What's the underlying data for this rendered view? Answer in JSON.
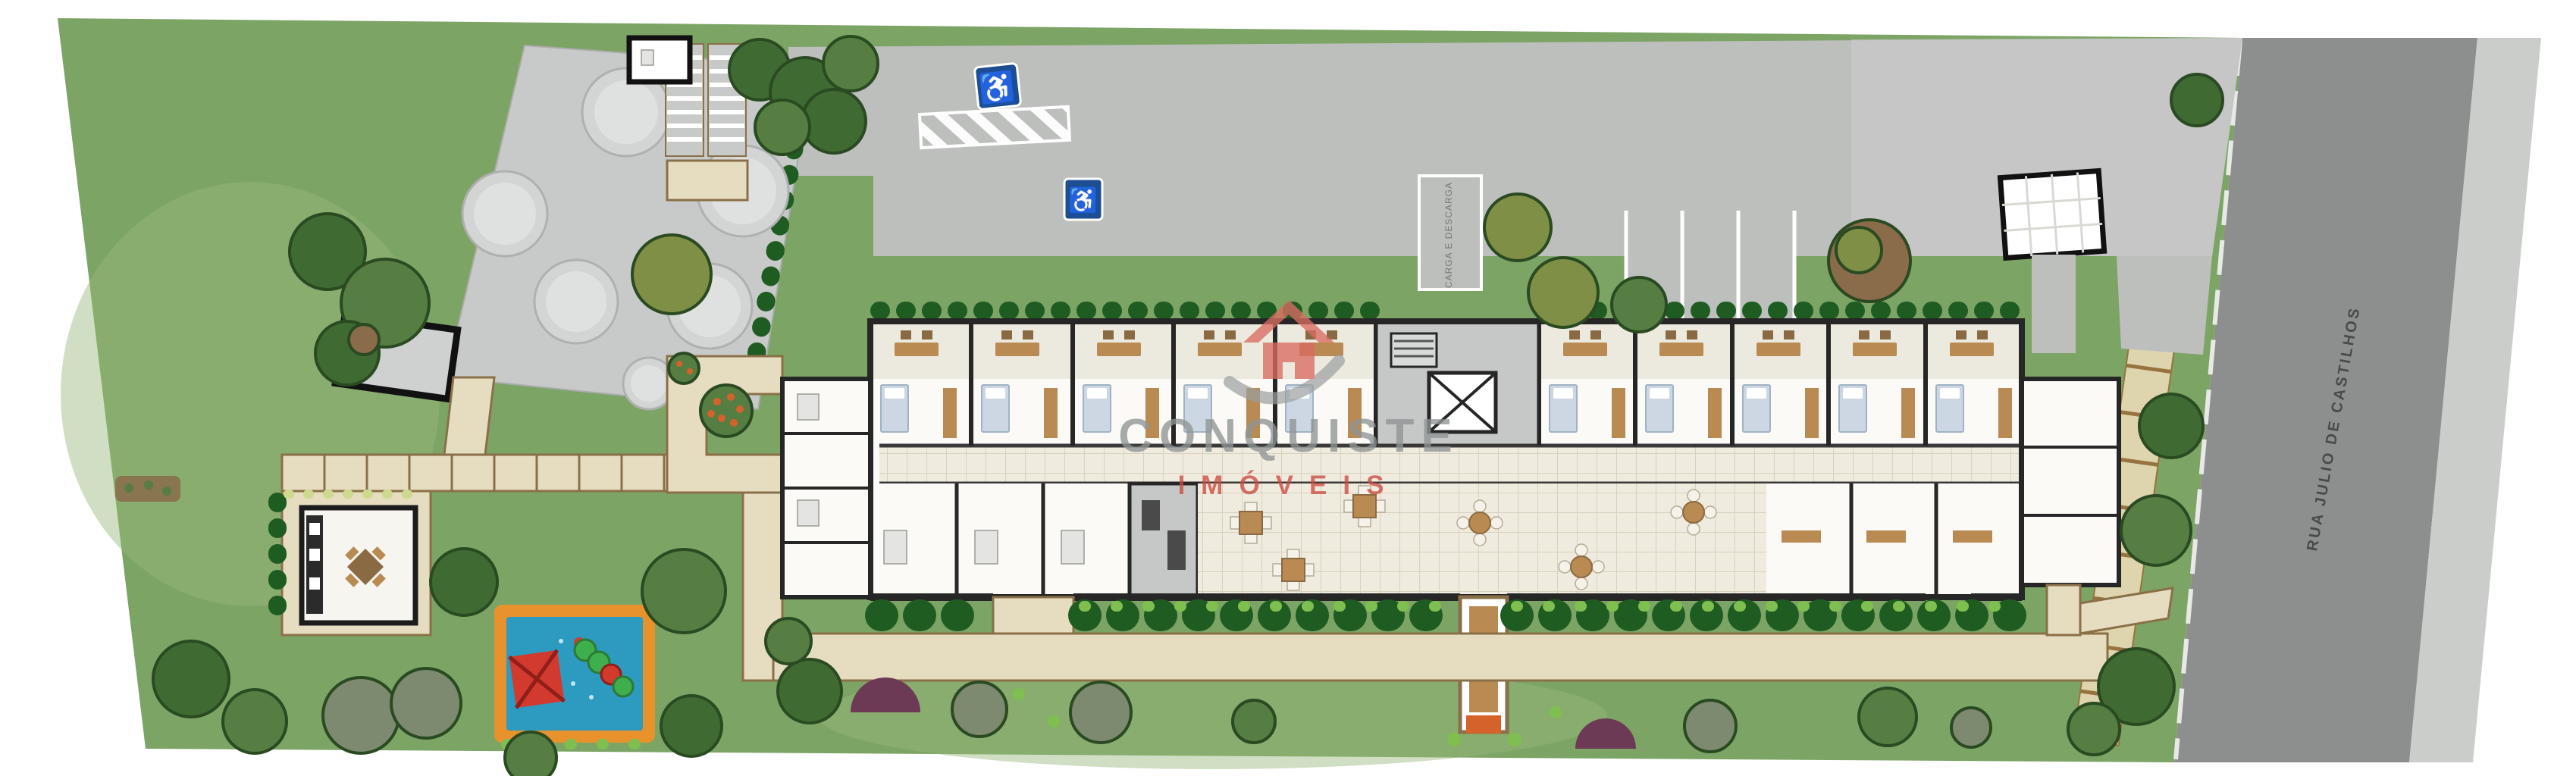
{
  "watermark": {
    "brand": "CONQUISTE",
    "segment": "IMÓVEIS"
  },
  "street": {
    "name": "RUA JULIO DE CASTILHOS"
  },
  "parking": {
    "loading_label": "CARGA E DESCARGA",
    "accessible_symbol": "♿"
  },
  "colors": {
    "white": "#ffffff",
    "grass": "#7ca465",
    "grass_light": "#96b879",
    "hedge_dark": "#1f5c22",
    "hedge_light": "#7fbf4f",
    "tree_dark": "#3f6b33",
    "tree_mid": "#567d42",
    "tree_olive": "#7f8f45",
    "tree_gray": "#7d8a6f",
    "tree_brown": "#8a6b4a",
    "tree_stroke": "#2a4a22",
    "bush_purple": "#6d3a55",
    "path": "#e6ddc1",
    "path_border": "#8a7048",
    "slab": "#ded4ad",
    "slab_joint": "#97743f",
    "drive": "#bdbfbd",
    "drive_light": "#c9cbc9",
    "street": "#8d8f8e",
    "sidewalk": "#cbcdcb",
    "curb": "#f2f2f2",
    "pad": "#c8cac9",
    "tank": "#d3d5d4",
    "tank_hi": "#dfe1e0",
    "tank_edge": "#aeb1b0",
    "wall": "#262626",
    "room": "#fbfaf7",
    "room_gray": "#c6c8c7",
    "fixture": "#e4e4e2",
    "tile": "#f0ebdf",
    "tile_line": "#d9d1bd",
    "wood": "#b98a52",
    "wood_dark": "#8a6a43",
    "bed": "#cdd7e4",
    "bed_edge": "#9fb3c4",
    "sign_blue": "#1d4e91",
    "play_orange": "#e8922e",
    "play_blue": "#2d9ac0",
    "play_red": "#d23a2e",
    "play_green": "#3faf4e",
    "flower_orange": "#d4622a",
    "label_gray": "#4a4a4a",
    "stall_text": "#777777",
    "watermark_gray": "#8f9494",
    "watermark_red": "#cc4b41"
  }
}
